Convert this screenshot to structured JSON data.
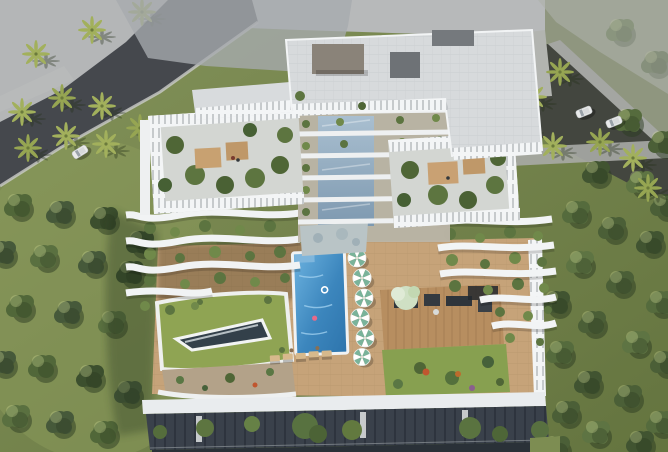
{
  "scene": {
    "kind": "aerial-architectural-render",
    "subject": "top-down render of a luxury residential building with terraced green balconies, rooftop amenity deck, swimming pool and surrounding trees",
    "counts": {
      "pool_umbrellas": 6,
      "cars_left_road": 1,
      "cars_right_road": 3
    }
  },
  "palette": {
    "grass_light": "#8a9a5c",
    "grass_dark": "#64743f",
    "forest_green": "#4b5f37",
    "palm_frond": "#a2b05c",
    "asphalt": "#45484d",
    "pavement": "#b4b6b7",
    "sidewalk": "#a4a6a2",
    "ghost_gray": "#a6aaae",
    "building_white": "#eef0f2",
    "roof_tile": "#d7dadc",
    "roof_box_dark": "#6e7276",
    "roof_box_brown": "#8a8379",
    "glass_blue": "#8fa8bf",
    "pool_blue": "#2d74ac",
    "pool_light": "#6db3e0",
    "deck_beige": "#c6a379",
    "lawn_green": "#8fa453",
    "skylight_dark": "#33404a",
    "umbrella_teal": "#79b39a",
    "wood_deck": "#b78e60",
    "furniture_dark": "#2f353b",
    "facade_dark": "#3a414b",
    "facade_base": "#2a3138",
    "canopy_white": "#e9ecee",
    "car_white": "#e9eaea",
    "flower_red": "#c0562f",
    "flower_orange": "#bd6b2d",
    "swimmer_pink": "#e86a8a"
  }
}
